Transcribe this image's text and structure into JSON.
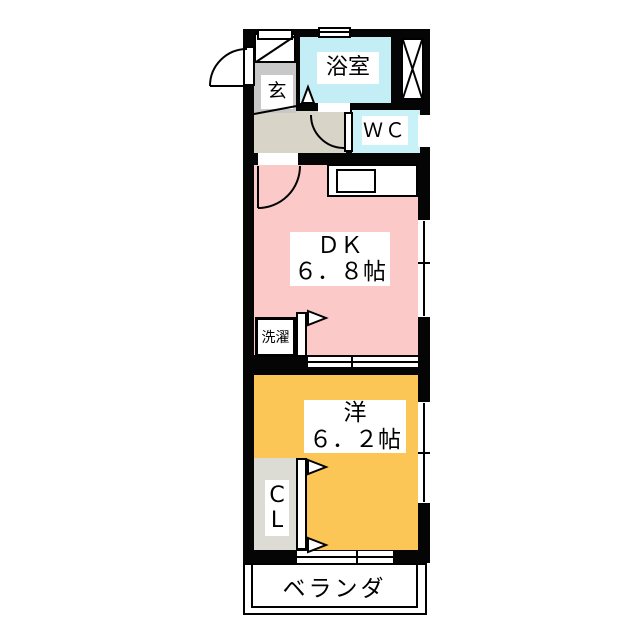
{
  "rooms": {
    "entrance": {
      "label": "玄"
    },
    "bathroom": {
      "label": "浴室"
    },
    "toilet": {
      "label": "ＷＣ"
    },
    "dining_kitchen": {
      "label": "ＤＫ",
      "size": "６．８帖"
    },
    "laundry": {
      "label": "洗濯"
    },
    "western_room": {
      "label": "洋",
      "size": "６．２帖"
    },
    "closet": {
      "label_line1": "C",
      "label_line2": "L"
    },
    "veranda": {
      "label": "ベランダ"
    }
  },
  "colors": {
    "wall": "#050505",
    "dining_kitchen": "#fcc9c9",
    "western_room": "#fcc656",
    "bathroom": "#c3eef6",
    "toilet": "#c9f1f8",
    "entrance": "#c8c8c8",
    "hallway": "#d8d4c7",
    "closet": "#dcdcd4",
    "veranda": "#ffffff"
  }
}
